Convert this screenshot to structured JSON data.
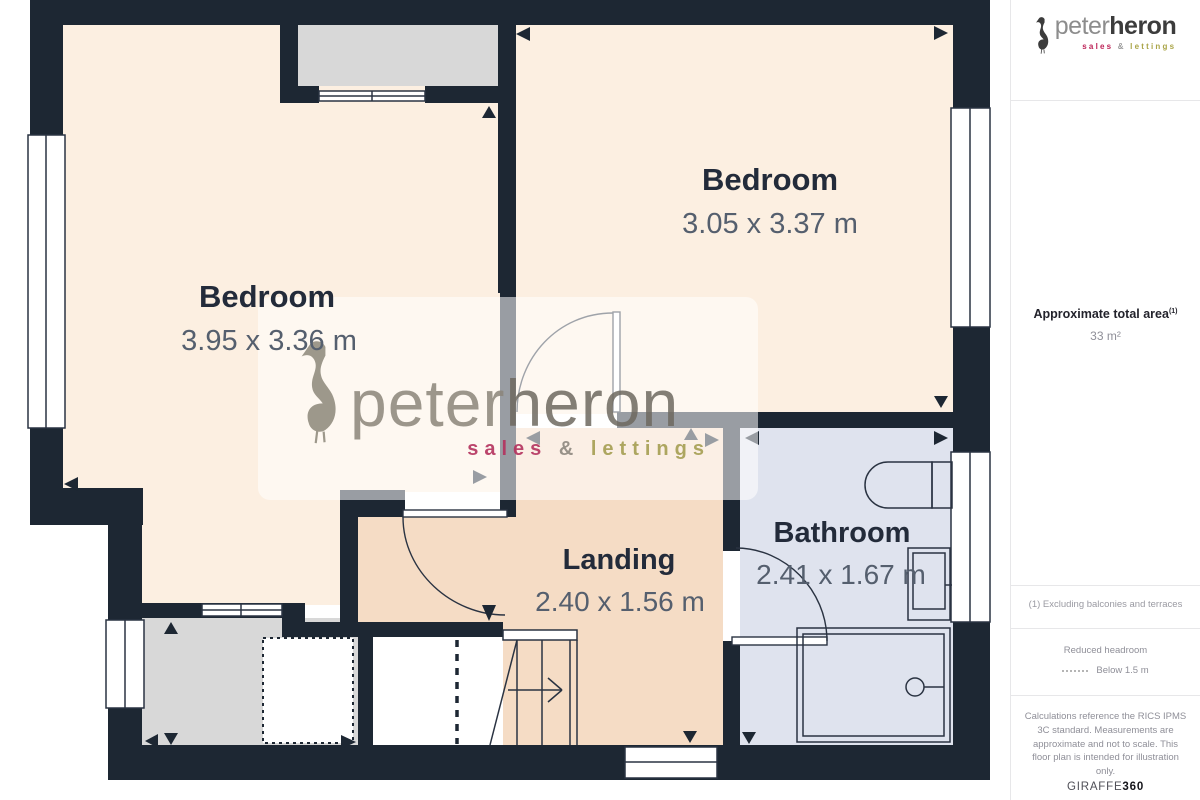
{
  "floorplan": {
    "rooms": [
      {
        "name": "Bedroom",
        "dims": "3.95 x 3.36 m"
      },
      {
        "name": "Bedroom",
        "dims": "3.05 x 3.37 m"
      },
      {
        "name": "Landing",
        "dims": "2.40 x 1.56 m"
      },
      {
        "name": "Bathroom",
        "dims": "2.41 x 1.67 m"
      }
    ],
    "watermark": {
      "peter": "peter",
      "heron": "heron",
      "sales": "sales",
      "amp": "&",
      "lettings": "lettings"
    },
    "colors": {
      "wall": "#1d2733",
      "bedroom": "#fcefe1",
      "landing": "#f5dcc5",
      "bathroom": "#dfe3ee",
      "storage": "#d8d8d8",
      "room_name": "#232b3a",
      "room_dims": "#555f6e"
    }
  },
  "sidebar": {
    "logo": {
      "peter": "peter",
      "heron": "heron",
      "sales": "sales",
      "amp": "&",
      "lettings": "lettings"
    },
    "area_label": "Approximate total area",
    "area_sup": "(1)",
    "area_value": "33 m²",
    "footnote": "(1) Excluding balconies and terraces",
    "legend_title": "Reduced headroom",
    "legend_value": "Below 1.5 m",
    "disclaimer": "Calculations reference the RICS IPMS 3C standard. Measurements are approximate and not to scale. This floor plan is intended for illustration only.",
    "credit_normal": "GIRAFFE",
    "credit_bold": "360"
  }
}
